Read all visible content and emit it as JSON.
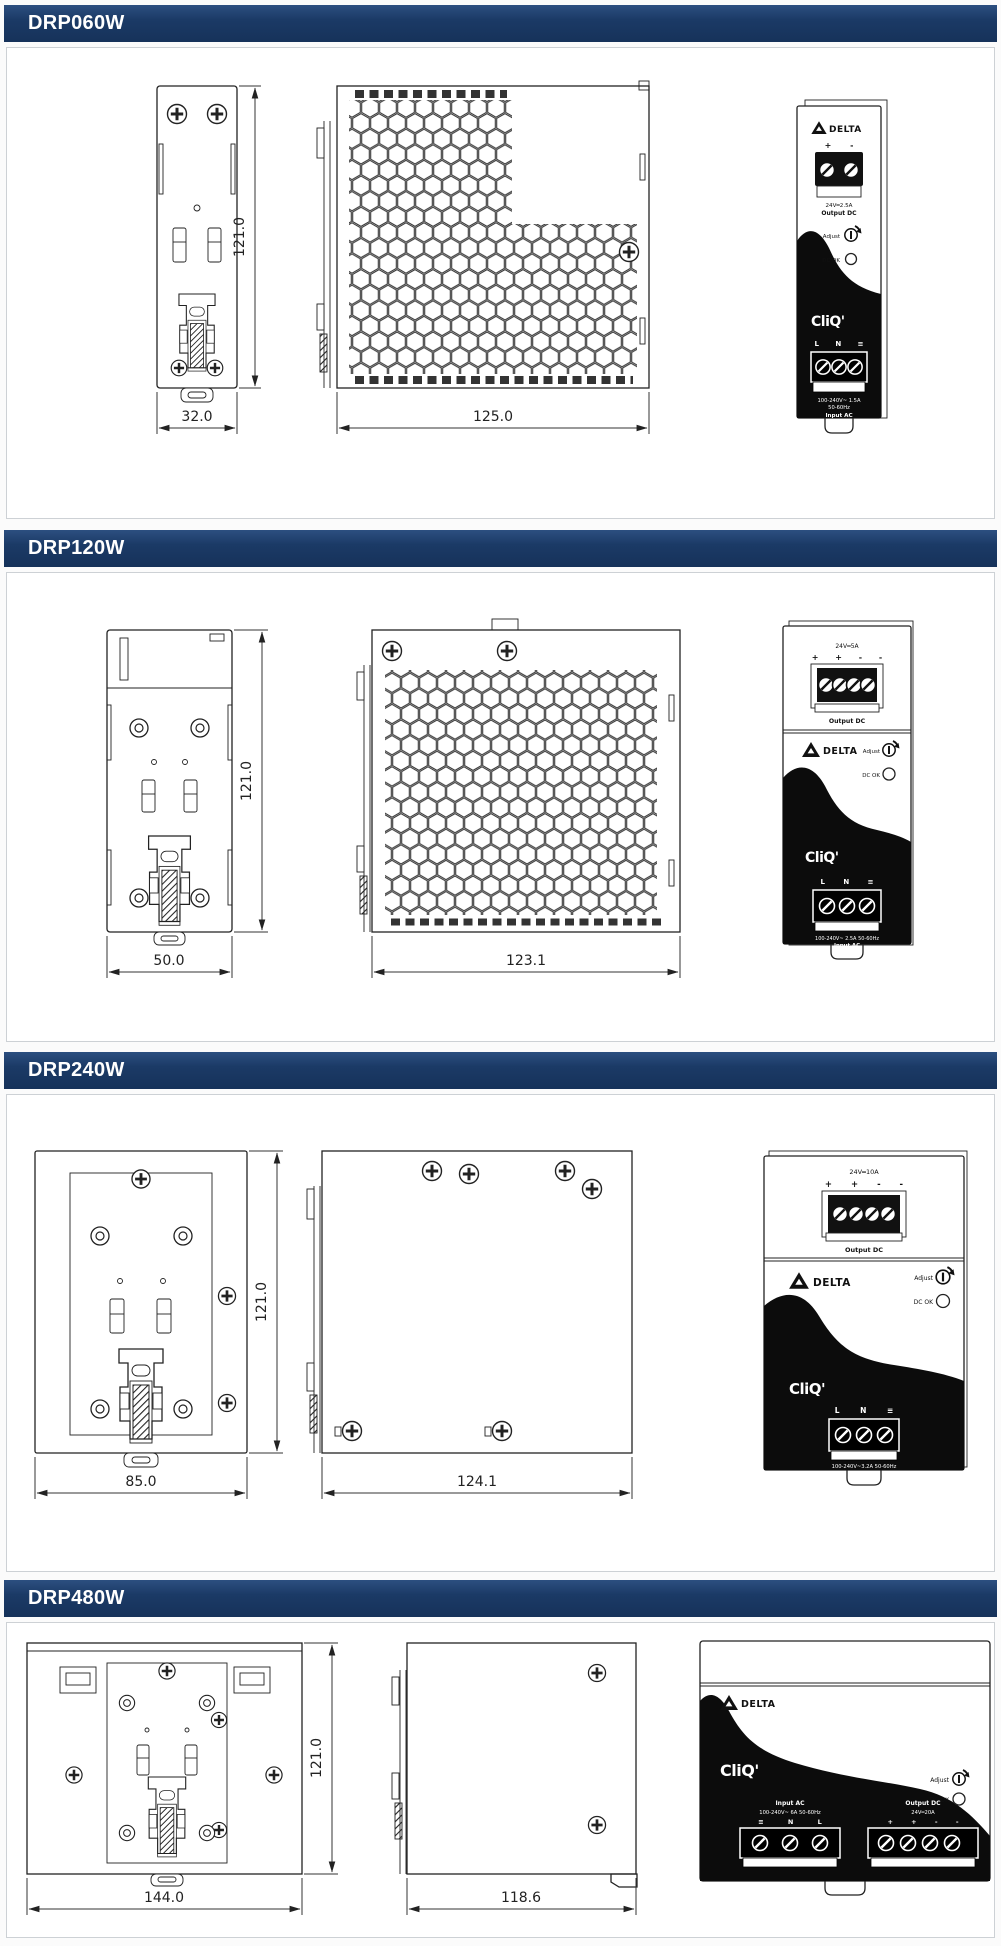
{
  "theme": {
    "header_bg": "#1b3a66",
    "header_text": "#ffffff",
    "panel_bg": "#ffffff",
    "line_color": "#222222"
  },
  "sections": [
    {
      "title": "DRP060W",
      "dims": {
        "height": "121.0",
        "width": "32.0",
        "depth": "125.0"
      },
      "front": {
        "brand": "DELTA",
        "out_pol": "+ -",
        "out_rating": "24V═2.5A",
        "out_label": "Output DC",
        "adjust": "Adjust",
        "dc_ok": "DC OK",
        "logo": "CliQ'",
        "in_pol": "L N ≡",
        "in_rating": "100-240V~ 1.5A",
        "in_freq": "50-60Hz",
        "in_label": "Input AC"
      }
    },
    {
      "title": "DRP120W",
      "dims": {
        "height": "121.0",
        "width": "50.0",
        "depth": "123.1"
      },
      "front": {
        "brand": "DELTA",
        "out_rating": "24V═5A",
        "out_pol": "+ + - -",
        "out_label": "Output DC",
        "adjust": "Adjust",
        "dc_ok": "DC OK",
        "logo": "CliQ'",
        "in_pol": "L N ≡",
        "in_rating": "100-240V~ 2.5A 50-60Hz",
        "in_label": "Input AC"
      }
    },
    {
      "title": "DRP240W",
      "dims": {
        "height": "121.0",
        "width": "85.0",
        "depth": "124.1"
      },
      "front": {
        "brand": "DELTA",
        "out_rating": "24V═10A",
        "out_pol": "+ + - -",
        "out_label": "Output DC",
        "adjust": "Adjust",
        "dc_ok": "DC OK",
        "logo": "CliQ'",
        "in_pol": "L N ≡",
        "in_rating": "100-240V~3.2A 50-60Hz",
        "in_label": "Input AC"
      }
    },
    {
      "title": "DRP480W",
      "dims": {
        "height": "121.0",
        "width": "144.0",
        "depth": "118.6"
      },
      "front": {
        "brand": "DELTA",
        "logo": "CliQ'",
        "adjust": "Adjust",
        "dc_ok": "DC OK",
        "in_label": "Input AC",
        "in_rating": "100-240V~ 6A 50-60Hz",
        "in_pol": "≡ N L",
        "out_label": "Output DC",
        "out_rating": "24V═20A",
        "out_pol": "+ + - -"
      }
    }
  ]
}
